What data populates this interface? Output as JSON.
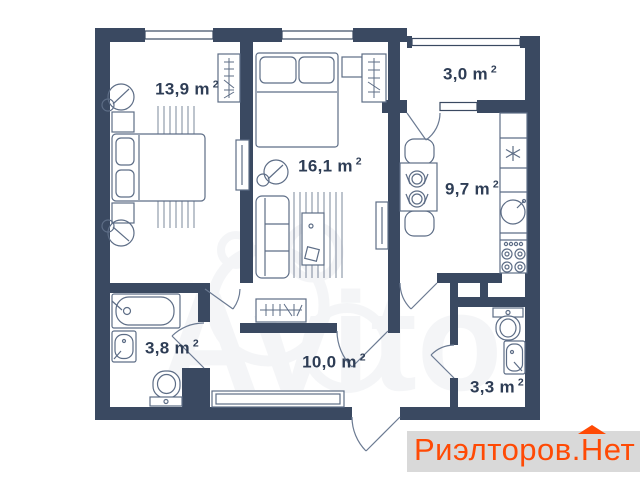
{
  "plan": {
    "rooms": [
      {
        "id": "bedroom",
        "area_label": "13,9 m",
        "sup": "2"
      },
      {
        "id": "living",
        "area_label": "16,1 m",
        "sup": "2"
      },
      {
        "id": "balcony",
        "area_label": "3,0 m",
        "sup": "2"
      },
      {
        "id": "kitchen",
        "area_label": "9,7 m",
        "sup": "2"
      },
      {
        "id": "bathroom",
        "area_label": "3,8 m",
        "sup": "2"
      },
      {
        "id": "hallway",
        "area_label": "10,0 m",
        "sup": "2"
      },
      {
        "id": "toilet",
        "area_label": "3,3 m",
        "sup": "2"
      }
    ],
    "colors": {
      "wall": "#3a4961",
      "furniture_line": "#5d6d86",
      "label_text": "#2e3d55",
      "background": "#ffffff"
    }
  },
  "watermark": {
    "text": "Avito"
  },
  "brand_badge": {
    "prefix": "Риэлторов.",
    "roof_letter": "Н",
    "suffix": "ет",
    "color": "#ff4a05",
    "background": "#d9d9d9"
  }
}
